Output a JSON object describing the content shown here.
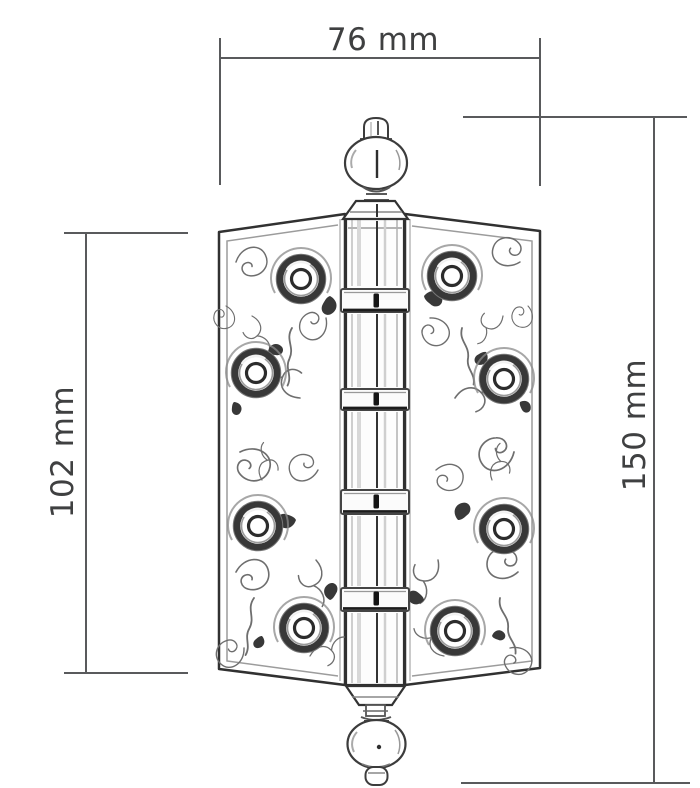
{
  "diagram": {
    "subject": "ornate-ball-tip-door-hinge-dimension-drawing",
    "dimensions": {
      "width": {
        "label": "76 mm",
        "value": 76,
        "unit": "mm"
      },
      "leaf_height": {
        "label": "102 mm",
        "value": 102,
        "unit": "mm"
      },
      "overall_height": {
        "label": "150 mm",
        "value": 150,
        "unit": "mm"
      }
    },
    "colors": {
      "dimension_line": "#595a5c",
      "dimension_text": "#3f4041",
      "artwork_line": "#2f2f2f",
      "background": "#ffffff"
    }
  }
}
